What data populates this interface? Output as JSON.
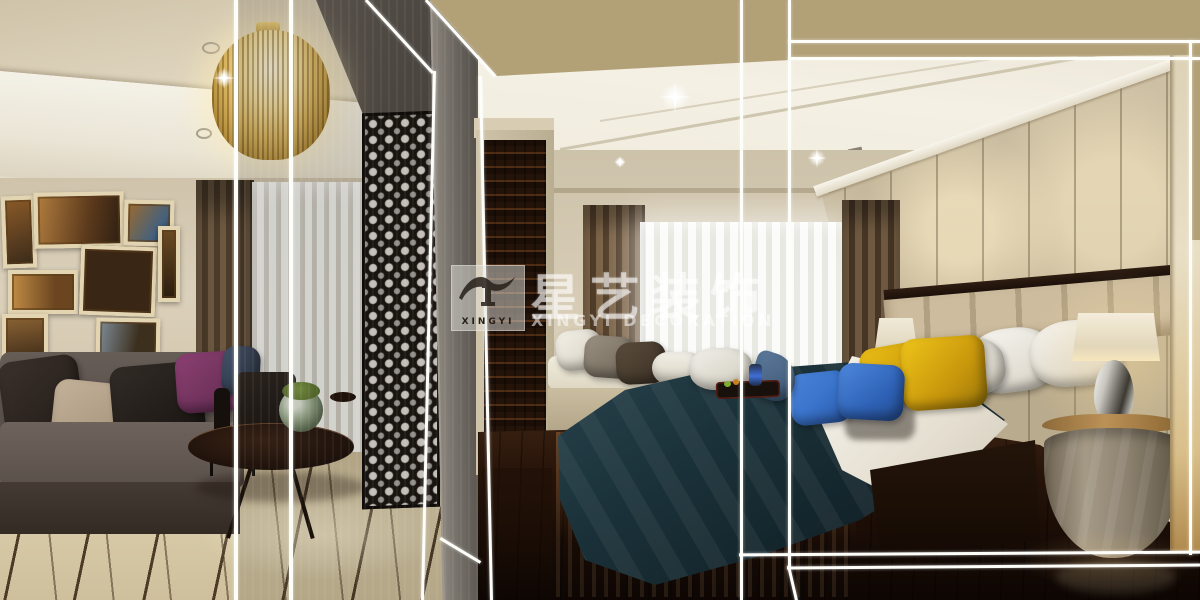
{
  "meta": {
    "type": "interior-design photograph (3D render collage)",
    "width_px": 1200,
    "height_px": 600,
    "description": "Split view: modern living room with mirrored pillar and lattice screen on the left, master bedroom with dark-teal bed on the right; tan banner overlay across the top right and thin white frame lines over the whole image; translucent company watermark in the middle."
  },
  "watermark": {
    "cn": "星艺装饰",
    "en": "XINGYI  DECORATION",
    "logo_text": "XINGYI",
    "logo_icon": "house-roof-and-column-icon"
  },
  "colors": {
    "tan_overlay": "#b2a077",
    "overlay_line": "#fdfdfa",
    "watermark_white": "rgba(255,255,255,0.55)",
    "living_ceiling": "#d6cbb2",
    "cove_white": "#f1eee3",
    "wall_beige": "#d8cdb6",
    "curtain_brown": "#6b5740",
    "sheer_white": "#f4f5f1",
    "sofa_gray": "#5d5450",
    "pillow_purple": "#8c4073",
    "marble_floor": "#d3c5a1",
    "floor_inlay": "#463320",
    "lattice_dark": "#181310",
    "column_gray": "#7d7871",
    "cabinet_wood": "#351d0e",
    "bed_ceiling": "#f2eee2",
    "marble_wall": "#c9bca0",
    "drape_brown": "#6f5a41",
    "duvet_teal": "#16272e",
    "sheet_white": "#f1efe7",
    "pillow_yellow": "#d8a90f",
    "pillow_blue": "#3a74cc",
    "headboard_beige": "#c6b493",
    "lamp_shade": "#efe8d4",
    "nightstand_marble": "#97896f",
    "wood_floor_dark": "#1f1007",
    "door_frame_cream": "#e3d7ba"
  },
  "scene": {
    "living_room": [
      "crystal-chandelier",
      "recessed-ceiling-spots",
      "gallery-picture-frames",
      "brown-curtain",
      "white-sheer-curtain",
      "gray-sofa",
      "throw-pillows-brown-beige-black-purple-slate",
      "dark-armchair",
      "black-side-table-with-vases",
      "oval-coffee-table",
      "moss-ball-glass-bowl",
      "beige-marble-floor-with-dark-inlay",
      "mirrored-pillar",
      "black-lattice-screen",
      "gray-column"
    ],
    "hallway": [
      "carved-dark-wood-cabinet",
      "cream-door-frame"
    ],
    "bedroom": [
      "white-coffered-ceiling",
      "crown-molding",
      "marble-feature-wall",
      "bay-window-with-sheers",
      "brown-drapes",
      "window-seat-cushion-with-pillows",
      "tufted-headboard-wood-trim",
      "white-pillows",
      "yellow-pillows",
      "blue-pillows",
      "dark-teal-duvet",
      "white-sheet-fold",
      "breakfast-tray-with-blue-teapot",
      "table-lamp-left",
      "chrome-teardrop-table-lamp-right",
      "round-marble-nightstand",
      "dark-glossy-wood-floor",
      "cream-door-frame-right-edge"
    ],
    "overlays": [
      "tan-banner-top-right",
      "white-frame-lines",
      "lens-sparkles",
      "xingyi-watermark"
    ]
  }
}
